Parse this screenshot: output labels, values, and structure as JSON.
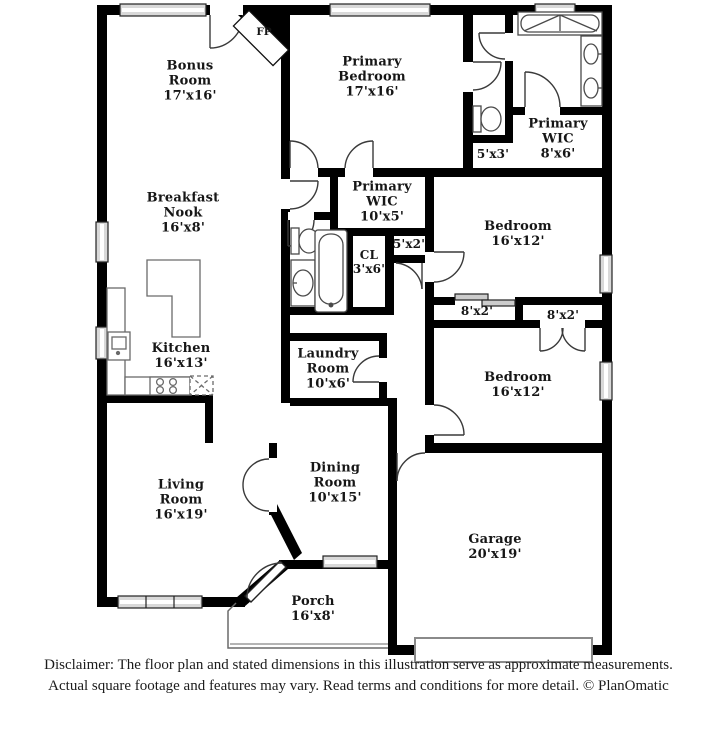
{
  "rooms": {
    "bonus": {
      "name": "Bonus Room",
      "dims": "17'x16'"
    },
    "primary_bedroom": {
      "name": "Primary Bedroom",
      "dims": "17'x16'"
    },
    "primary_wic_upper": {
      "name": "Primary WIC",
      "dims": "8'x6'"
    },
    "primary_wic_lower": {
      "name": "Primary WIC",
      "dims": "10'x5'"
    },
    "breakfast_nook": {
      "name": "Breakfast Nook",
      "dims": "16'x8'"
    },
    "bedroom_upper": {
      "name": "Bedroom",
      "dims": "16'x12'"
    },
    "bedroom_lower": {
      "name": "Bedroom",
      "dims": "16'x12'"
    },
    "kitchen": {
      "name": "Kitchen",
      "dims": "16'x13'"
    },
    "laundry": {
      "name": "Laundry Room",
      "dims": "10'x6'"
    },
    "living": {
      "name": "Living Room",
      "dims": "16'x19'"
    },
    "dining": {
      "name": "Dining Room",
      "dims": "10'x15'"
    },
    "garage": {
      "name": "Garage",
      "dims": "20'x19'"
    },
    "porch": {
      "name": "Porch",
      "dims": "16'x8'"
    },
    "hall_closet": {
      "name": "CL",
      "dims": "3'x6'"
    }
  },
  "labels": {
    "fireplace": "FP",
    "water_closet_dims": "5'x3'",
    "linen_closet_dims": "5'x2'",
    "bedroom_upper_closet_dims": "8'x2'",
    "bedroom_lower_closet_dims": "8'x2'"
  },
  "disclaimer": {
    "line1": "Disclaimer: The floor plan and stated dimensions in this illustration serve as approximate measurements.",
    "line2": "Actual square footage and features may vary. Read terms and conditions for more detail. © PlanOmatic"
  },
  "colors": {
    "wall": "#000000",
    "background": "#ffffff",
    "window_fill": "#e6e6e6",
    "fixture_line": "#444444"
  }
}
